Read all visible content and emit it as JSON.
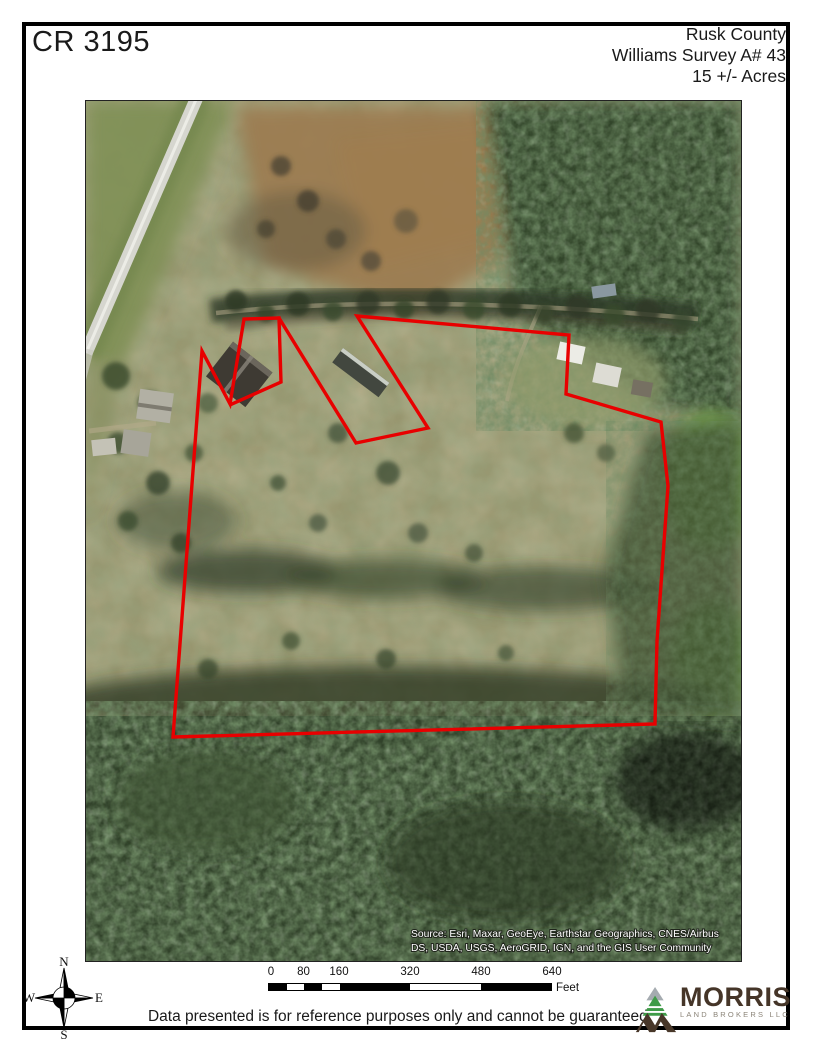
{
  "header": {
    "title": "CR 3195",
    "county": "Rusk County",
    "survey": "Williams Survey A# 43",
    "acreage": "15 +/- Acres"
  },
  "map": {
    "attribution_line1": "Source: Esri, Maxar, GeoEye, Earthstar Geographics, CNES/Airbus",
    "attribution_line2": "DS, USDA, USGS, AeroGRID, IGN, and the GIS User Community",
    "boundary_color": "#e80000",
    "boundary_main_points": "271,215 483,234 480,293 575,321 582,385 571,540 569,623 87,636 116,250 144,303 158,218 193,217 270,342 342,327",
    "boundary_inner_points": "193,217 195,281 146,303"
  },
  "scalebar": {
    "labels": [
      "0",
      "80",
      "160",
      "320",
      "480",
      "640"
    ],
    "unit": "Feet"
  },
  "compass": {
    "n": "N",
    "s": "S",
    "e": "E",
    "w": "W"
  },
  "footer": {
    "disclaimer": "Data presented is for reference purposes only and cannot be guaranteed."
  },
  "logo": {
    "name": "MORRIS",
    "subtitle": "LAND BROKERS LLC"
  }
}
